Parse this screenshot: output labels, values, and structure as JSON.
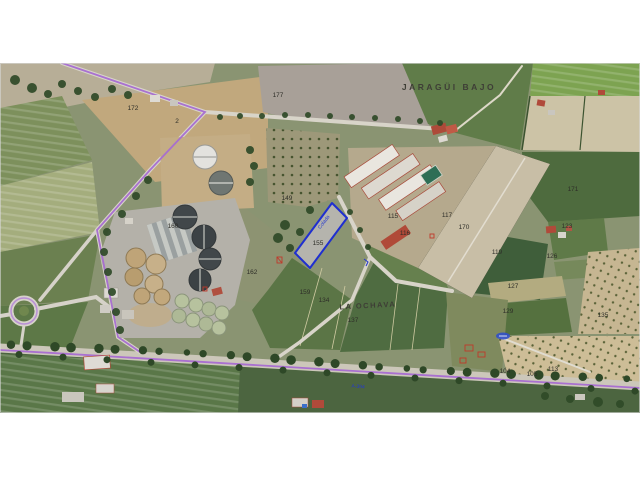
{
  "map": {
    "type": "aerial-cadastral-view",
    "place_labels": [
      {
        "t": "JARAGÜI BAJO",
        "x": 449,
        "y": 90,
        "size": 8.5,
        "spacing": 2.5,
        "rotate": 0
      },
      {
        "t": "LA OCHAVA",
        "x": 368,
        "y": 308,
        "size": 7.5,
        "spacing": 1.5,
        "rotate": -3
      }
    ],
    "road_labels": [
      {
        "t": "Colada",
        "x": 325,
        "y": 223,
        "size": 5,
        "rotate": -52
      },
      {
        "t": "A-394",
        "x": 358,
        "y": 388,
        "size": 5,
        "rotate": 4
      }
    ],
    "highlighted_parcel": {
      "number": "155",
      "outline_color": "#1f2fd0"
    },
    "parcel_numbers": [
      {
        "t": "172",
        "x": 133,
        "y": 110
      },
      {
        "t": "2",
        "x": 177,
        "y": 123
      },
      {
        "t": "177",
        "x": 278,
        "y": 97
      },
      {
        "t": "149",
        "x": 287,
        "y": 200
      },
      {
        "t": "160",
        "x": 173,
        "y": 228
      },
      {
        "t": "162",
        "x": 252,
        "y": 274
      },
      {
        "t": "155",
        "x": 318,
        "y": 245
      },
      {
        "t": "159",
        "x": 305,
        "y": 294
      },
      {
        "t": "134",
        "x": 324,
        "y": 302
      },
      {
        "t": "137",
        "x": 353,
        "y": 322
      },
      {
        "t": "115",
        "x": 393,
        "y": 218
      },
      {
        "t": "116",
        "x": 405,
        "y": 235
      },
      {
        "t": "117",
        "x": 447,
        "y": 217
      },
      {
        "t": "170",
        "x": 464,
        "y": 229
      },
      {
        "t": "119",
        "x": 497,
        "y": 254
      },
      {
        "t": "171",
        "x": 573,
        "y": 191
      },
      {
        "t": "123",
        "x": 567,
        "y": 228
      },
      {
        "t": "126",
        "x": 552,
        "y": 258
      },
      {
        "t": "127",
        "x": 513,
        "y": 288
      },
      {
        "t": "129",
        "x": 508,
        "y": 313
      },
      {
        "t": "135",
        "x": 603,
        "y": 317
      },
      {
        "t": "104",
        "x": 505,
        "y": 373
      },
      {
        "t": "105",
        "x": 532,
        "y": 376
      },
      {
        "t": "113",
        "x": 553,
        "y": 371
      }
    ],
    "colors": {
      "background": "#ffffff",
      "field_green_dark": "#4d6a3e",
      "field_green": "#5a7444",
      "field_tan": "#c2a87e",
      "road_gray": "#d6d2c9",
      "via_pecuaria_purple": "#a66bd1",
      "highlight_blue": "#1f2fd0",
      "cadastral_red": "#c0392b",
      "label_dark": "#3e3e36"
    }
  }
}
